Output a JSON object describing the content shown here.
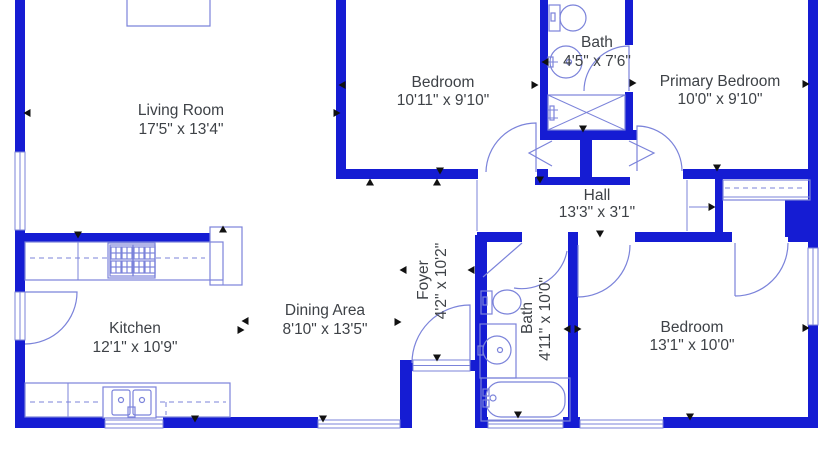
{
  "colors": {
    "wall": "#151cd3",
    "fixture": "#7b83da",
    "text": "#3e4247",
    "arrow": "#111111",
    "bg": "#ffffff"
  },
  "rooms": [
    {
      "id": "living-room",
      "name": "Living Room",
      "dims": "17'5\" x 13'4\""
    },
    {
      "id": "bedroom-top",
      "name": "Bedroom",
      "dims": "10'11\" x 9'10\""
    },
    {
      "id": "bath-top",
      "name": "Bath",
      "dims": "4'5\" x 7'6\""
    },
    {
      "id": "primary-bedroom",
      "name": "Primary Bedroom",
      "dims": "10'0\" x 9'10\""
    },
    {
      "id": "hall",
      "name": "Hall",
      "dims": "13'3\" x 3'1\""
    },
    {
      "id": "foyer",
      "name": "Foyer",
      "dims": "4'2\" x 10'2\""
    },
    {
      "id": "kitchen",
      "name": "Kitchen",
      "dims": "12'1\" x 10'9\""
    },
    {
      "id": "dining-area",
      "name": "Dining Area",
      "dims": "8'10\" x 13'5\""
    },
    {
      "id": "bath-lower",
      "name": "Bath",
      "dims": "4'11\" x 10'0\""
    },
    {
      "id": "bedroom-right",
      "name": "Bedroom",
      "dims": "13'1\" x 10'0\""
    }
  ],
  "fixtures": {
    "bath_top": [
      "toilet",
      "round-sink",
      "shower"
    ],
    "bath_lower": [
      "toilet",
      "vanity-sink",
      "bathtub"
    ],
    "kitchen": [
      "range-burners",
      "double-sink",
      "counters",
      "refrigerator"
    ],
    "closets": [
      "closet-rod-dashed",
      "hall-closet-doors"
    ]
  }
}
